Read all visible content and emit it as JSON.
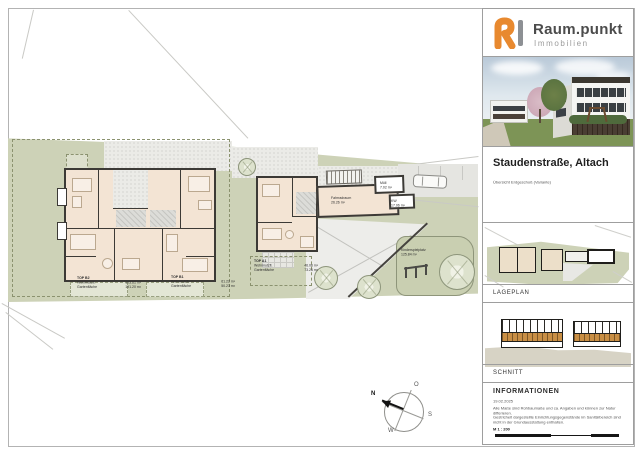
{
  "brand": {
    "name": "Raum.punkt",
    "tagline": "Immobilien",
    "accent": "#e8892f"
  },
  "titleblock": {
    "project": "Staudenstraße, Altach",
    "subtitle": "Übersicht Erdgeschoß (Variante)"
  },
  "sections": {
    "lageplan": "LAGEPLAN",
    "schnitt": "SCHNITT",
    "info": "INFORMATIONEN"
  },
  "info": {
    "date": "19.02.2025",
    "note1": "Alle Maße sind Rohbaumaße und ca. Angaben und können zur Natur differieren.",
    "note2": "Gestrichelt dargestellte Einrichtungsgegenstände im Sanitärbereich sind nicht in der Grundausstattung enthalten.",
    "scale": "M 1 : 200"
  },
  "units": [
    {
      "id": "TOP B2",
      "wohn_label": "Wohnnutzfl.",
      "wohn": "103.61 m²",
      "garten_label": "Gartenfläche",
      "garten": "191.20 m²"
    },
    {
      "id": "TOP B1",
      "wohn_label": "Wohnnutzfl.",
      "wohn": "61.22 m²",
      "garten_label": "Gartenfläche",
      "garten": "50.23 m²"
    },
    {
      "id": "TOP A1",
      "wohn_label": "Wohnnutzfl.",
      "wohn": "46.06 m²",
      "garten_label": "Gartenfläche",
      "garten": "73.26 m²"
    }
  ],
  "rooms": {
    "fahrrad": {
      "name": "Fahrradraum",
      "area": "26.26 m²"
    },
    "muell": {
      "name": "Müll",
      "area": "7.02 m²"
    },
    "kw": {
      "name": "KW",
      "area": "17.06 m²"
    },
    "spielplatz": {
      "name": "Kinderspielplatz",
      "area": "125.84 m²"
    }
  },
  "compass": {
    "n": "N",
    "o": "O",
    "s": "S",
    "w": "W"
  }
}
